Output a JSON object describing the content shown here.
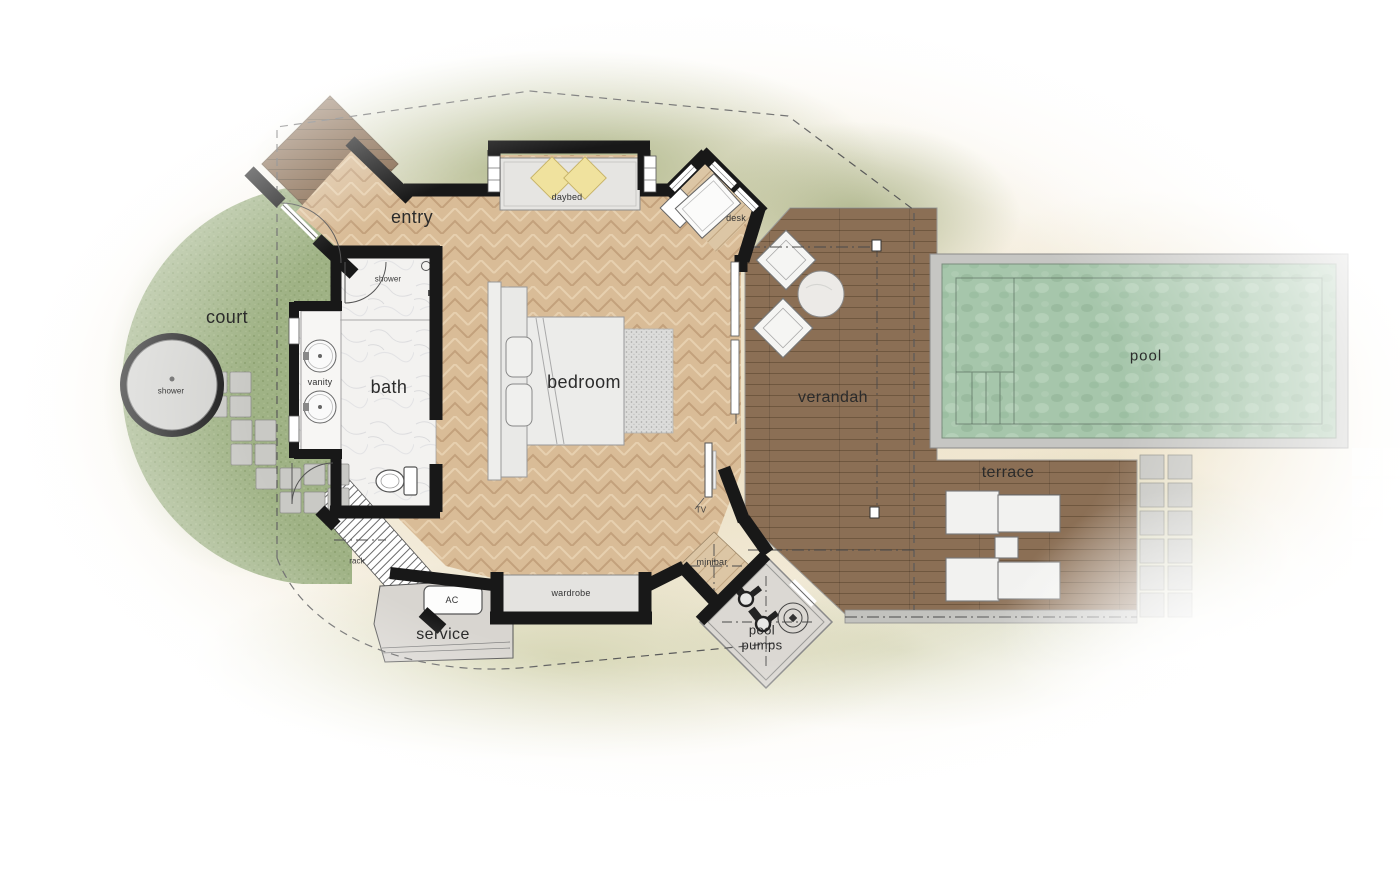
{
  "plan_title": "villa floor plan",
  "labels": {
    "entry": "entry",
    "court": "court",
    "outdoor_shower": "shower",
    "bath_shower": "shower",
    "vanity": "vanity",
    "bath": "bath",
    "bedroom": "bedroom",
    "daybed": "daybed",
    "desk": "desk",
    "tv": "TV",
    "minibar": "minibar",
    "wardrobe": "wardrobe",
    "rack": "rack",
    "ac": "AC",
    "service": "service",
    "verandah": "verandah",
    "terrace": "terrace",
    "pool": "pool",
    "pool_pumps": "pool\npumps"
  },
  "colors": {
    "wall": "#181818",
    "wood_floor": "#d9bc97",
    "deck": "#8b6f55",
    "entry_deck": "#85684d",
    "nook_wood": "#dcc6a5",
    "water": "#a6c6ab",
    "pool_coping": "#c6c6c3",
    "grass": "#9fb285",
    "marble": "#f3f2f0",
    "sand": "#ebdfc2",
    "stone": "#c9c9c5",
    "label_text": "#2b2b2b",
    "pillow_yellow": "#f0e29e"
  }
}
